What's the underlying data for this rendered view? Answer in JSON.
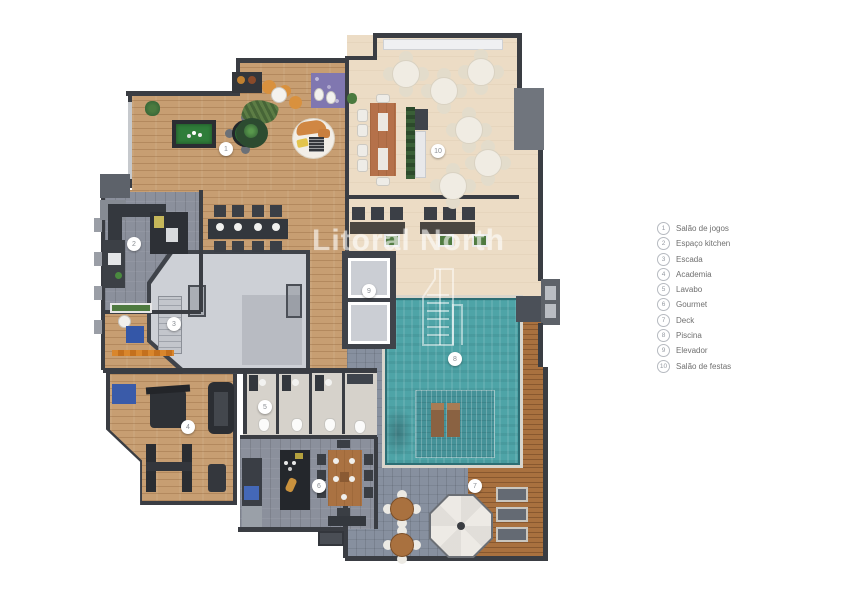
{
  "watermark": {
    "text": "Litoral North",
    "icon": "building-icon"
  },
  "legend": {
    "items": [
      {
        "num": "1",
        "label": "Salão de jogos"
      },
      {
        "num": "2",
        "label": "Espaço kitchen"
      },
      {
        "num": "3",
        "label": "Escada"
      },
      {
        "num": "4",
        "label": "Academia"
      },
      {
        "num": "5",
        "label": "Lavabo"
      },
      {
        "num": "6",
        "label": "Gourmet"
      },
      {
        "num": "7",
        "label": "Deck"
      },
      {
        "num": "8",
        "label": "Piscina"
      },
      {
        "num": "9",
        "label": "Elevador"
      },
      {
        "num": "10",
        "label": "Salão de festas"
      }
    ]
  },
  "plan": {
    "markers": [
      {
        "num": "1",
        "label": "Salão de jogos",
        "x": 226,
        "y": 149
      },
      {
        "num": "2",
        "label": "Espaço kitchen",
        "x": 134,
        "y": 244
      },
      {
        "num": "3",
        "label": "Escada",
        "x": 174,
        "y": 324
      },
      {
        "num": "4",
        "label": "Academia",
        "x": 188,
        "y": 427
      },
      {
        "num": "5",
        "label": "Lavabo",
        "x": 265,
        "y": 407
      },
      {
        "num": "6",
        "label": "Gourmet",
        "x": 319,
        "y": 486
      },
      {
        "num": "7",
        "label": "Deck",
        "x": 475,
        "y": 486
      },
      {
        "num": "8",
        "label": "Piscina",
        "x": 455,
        "y": 359
      },
      {
        "num": "9",
        "label": "Elevador",
        "x": 369,
        "y": 291
      },
      {
        "num": "10",
        "label": "Salão de festas",
        "x": 438,
        "y": 151
      }
    ],
    "palette": {
      "wood_floor": "#c79e72",
      "party_floor": "#ecdcc5",
      "gray_floor": "#8b909c",
      "pool_water": "#4ea4a7",
      "pool_shelf": "#459298",
      "deck_wood": "#a9713f",
      "wall": "#3a3d43",
      "stair_floor": "#cdd0d6"
    }
  }
}
